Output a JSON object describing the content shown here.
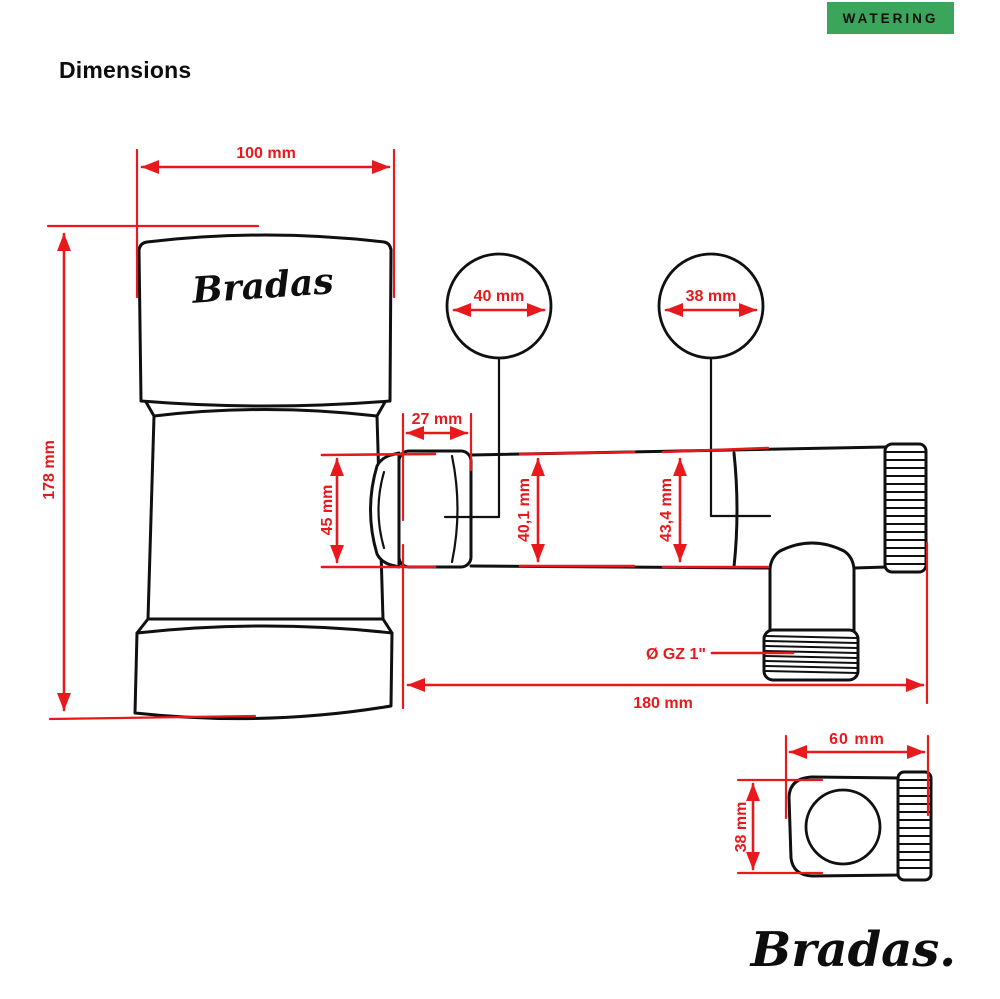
{
  "badge": {
    "label": "WATERING",
    "bg": "#3ca55c"
  },
  "heading": "Dimensions",
  "front_view": {
    "product_label": "Bradas",
    "dim_body_width": "100 mm",
    "dim_body_height": "178 mm",
    "dim_inlet_circle": "40 mm",
    "dim_knob_circle": "38 mm",
    "dim_nut_length": "27 mm",
    "dim_nut_height": "45 mm",
    "dim_pipe_left_diameter": "40,1 mm",
    "dim_pipe_right_diameter": "43,4 mm",
    "dim_outlet_thread": "Ø GZ 1\"",
    "dim_total_length": "180 mm"
  },
  "side_view": {
    "dim_width": "60 mm",
    "dim_height": "38 mm"
  },
  "brand_logo": "Bradas.",
  "colors": {
    "dimension_red": "#e8191d",
    "badge_green": "#3ca55c",
    "outline_black": "#101010"
  }
}
